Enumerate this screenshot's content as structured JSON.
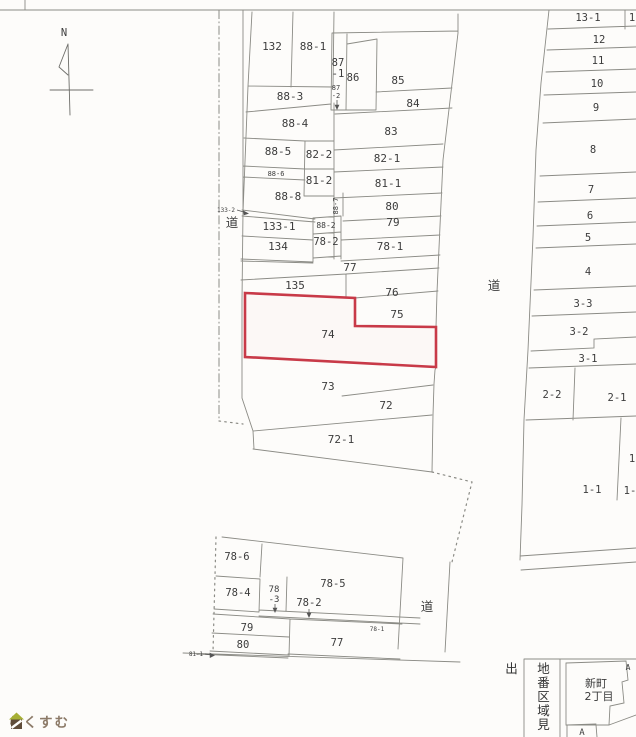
{
  "colors": {
    "highlight": "#c83a48",
    "line": "#8b8b85",
    "text": "#3c3c3c",
    "logo_text": "#8c7a68",
    "logo_roof": "#a6af35",
    "logo_body": "#5f4c39"
  },
  "compass": {
    "label": "N"
  },
  "upper_block": {
    "p132": "132",
    "p88_1": "88-1",
    "p87_1_l1": "87",
    "p87_1_l2": "-1",
    "p87_2_l1": "87",
    "p87_2_l2": "-2",
    "p86": "86",
    "p85": "85",
    "p84": "84",
    "p88_3": "88-3",
    "p88_4": "88-4",
    "p83": "83",
    "p88_5": "88-5",
    "p82_2": "82-2",
    "p82_1": "82-1",
    "p88_6": "88-6",
    "p81_2": "81-2",
    "p81_1": "81-1",
    "p88_8": "88-8",
    "p80": "80",
    "p88_7": "88-7",
    "p133_2": "133-2",
    "p133_1": "133-1",
    "p88_2": "88-2",
    "p79": "79",
    "p134": "134",
    "p78_2": "78-2",
    "p78_1": "78-1",
    "p77": "77",
    "p135": "135",
    "p76": "76",
    "p75": "75",
    "p74": "74",
    "p73": "73",
    "p72": "72",
    "p72_1": "72-1",
    "road_left": "道",
    "road_center": "道"
  },
  "right_column": {
    "p13_1": "13-1",
    "p13_2_cut": "1",
    "p12": "12",
    "p11": "11",
    "p10": "10",
    "p9": "9",
    "p8": "8",
    "p7": "7",
    "p6": "6",
    "p5": "5",
    "p4": "4",
    "p3_3": "3-3",
    "p3_2": "3-2",
    "p3_1": "3-1",
    "p2_2": "2-2",
    "p2_1": "2-1",
    "p1_cut": "1",
    "p1_1": "1-1",
    "p1_2_cut": "1-"
  },
  "lower_block": {
    "p78_6": "78-6",
    "p78_4": "78-4",
    "p78_3_l1": "78",
    "p78_3_l2": "-3",
    "p78_5": "78-5",
    "p78_2": "78-2",
    "p79": "79",
    "p80": "80",
    "p77": "77",
    "p78_1": "78-1",
    "p81_1": "81-1",
    "road": "道"
  },
  "legend": {
    "title": "地番区域見出",
    "district_line1": "新町",
    "district_line2": "2丁目",
    "marker_top": "A",
    "marker_bottom": "A"
  },
  "highlight": {
    "parcel": "74"
  },
  "logo": {
    "brand": "らくすむ"
  }
}
